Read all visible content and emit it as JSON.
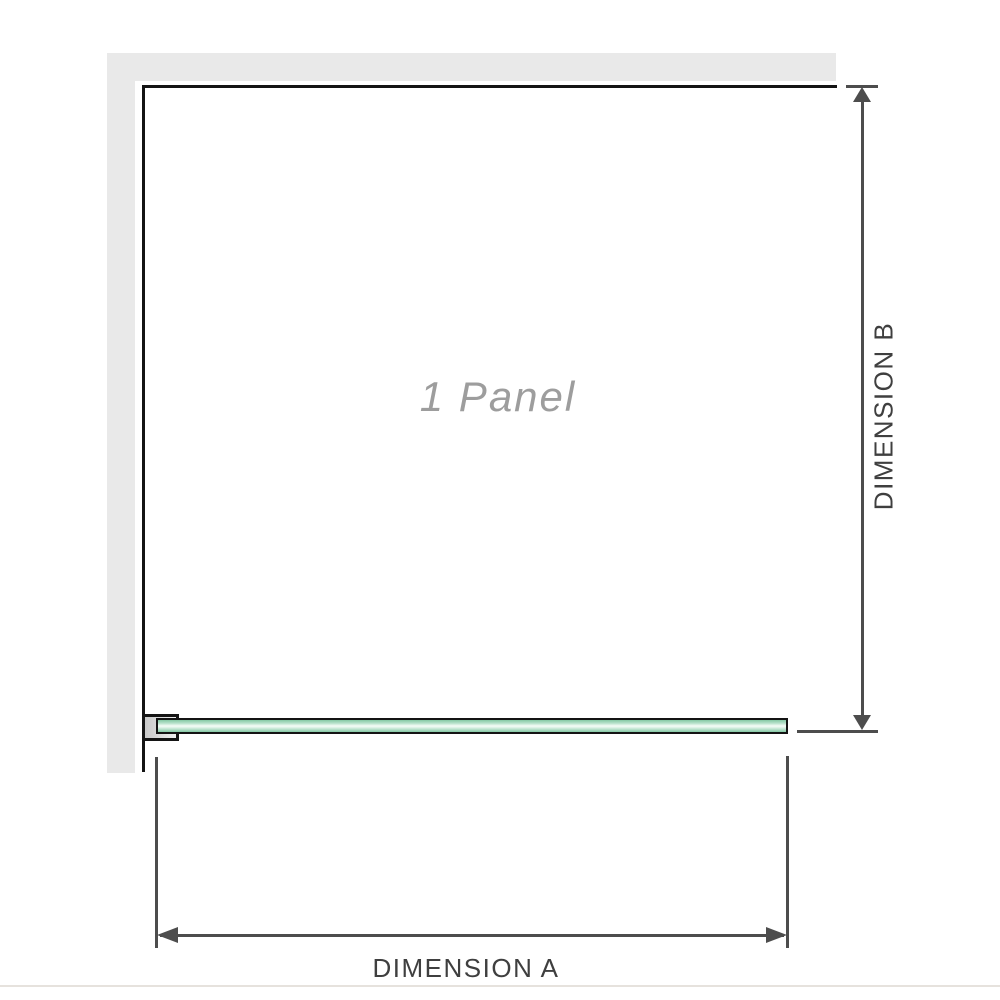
{
  "diagram": {
    "panel_label": "1 Panel",
    "dimension_a_label": "DIMENSION A",
    "dimension_b_label": "DIMENSION B"
  },
  "colors": {
    "wall_gray": "#e9e9e9",
    "edge_black": "#141414",
    "dim_gray": "#4d4d4d",
    "dim_text": "#3f3f3f",
    "panel_text": "#9d9d9d",
    "glass_dark": "#84c8a4",
    "glass_mid": "#b9e2cc",
    "glass_light": "#eef9f2",
    "bracket_from": "#c9c9c9",
    "bracket_to": "#f0f0f0",
    "footer_gray": "#e6e2dd"
  }
}
